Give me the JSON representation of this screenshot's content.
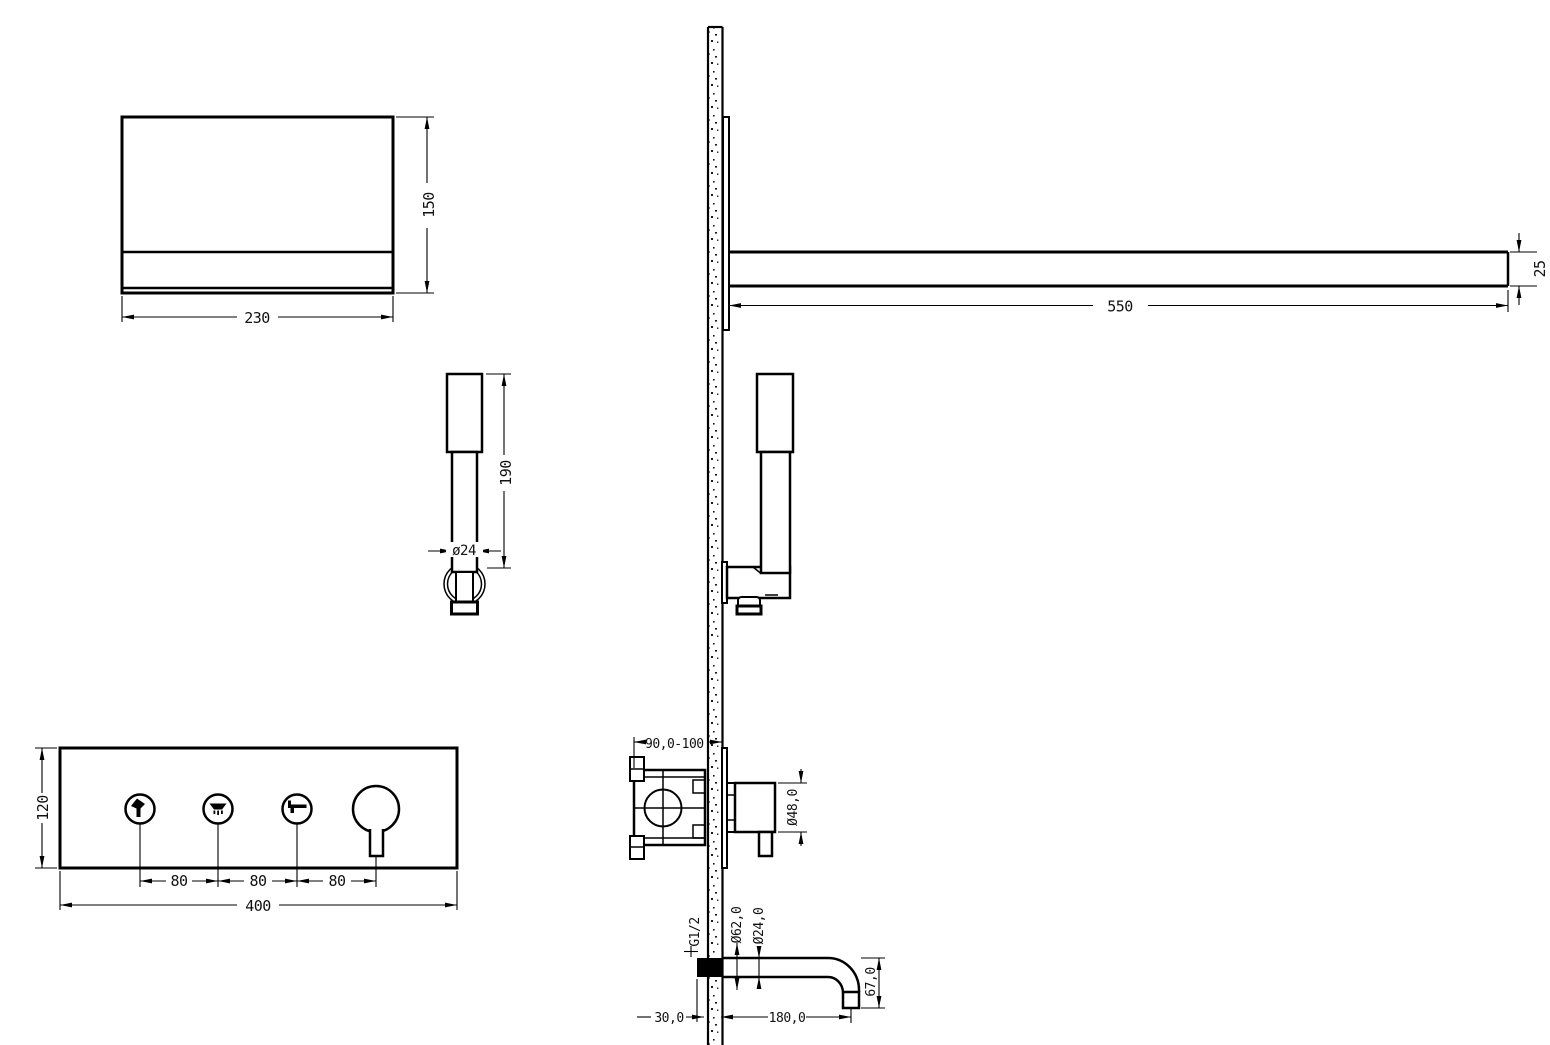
{
  "palette": {
    "line": "#000000",
    "background": "#ffffff"
  },
  "views": {
    "shower_head_front": {
      "width": "230",
      "height": "150"
    },
    "shower_arm_side": {
      "length": "550",
      "thickness": "25"
    },
    "hand_shower_front": {
      "length": "190",
      "diameter": "ø24"
    },
    "control_panel": {
      "height": "120",
      "width": "400",
      "spacings": [
        "80",
        "80",
        "80"
      ],
      "buttons": [
        {
          "icon": "hand-shower"
        },
        {
          "icon": "rain-shower"
        },
        {
          "icon": "bath-spout"
        },
        {
          "icon": "temperature-knob"
        }
      ]
    },
    "concealed_valve": {
      "install_depth": "90,0-100",
      "knob_diameter": "Ø48,0"
    },
    "bath_spout": {
      "thread": "G1/2",
      "escutcheon_diameter": "Ø62,0",
      "pipe_diameter": "Ø24,0",
      "drop_height": "67,0",
      "wall_stub": "30,0",
      "reach": "180,0"
    }
  }
}
